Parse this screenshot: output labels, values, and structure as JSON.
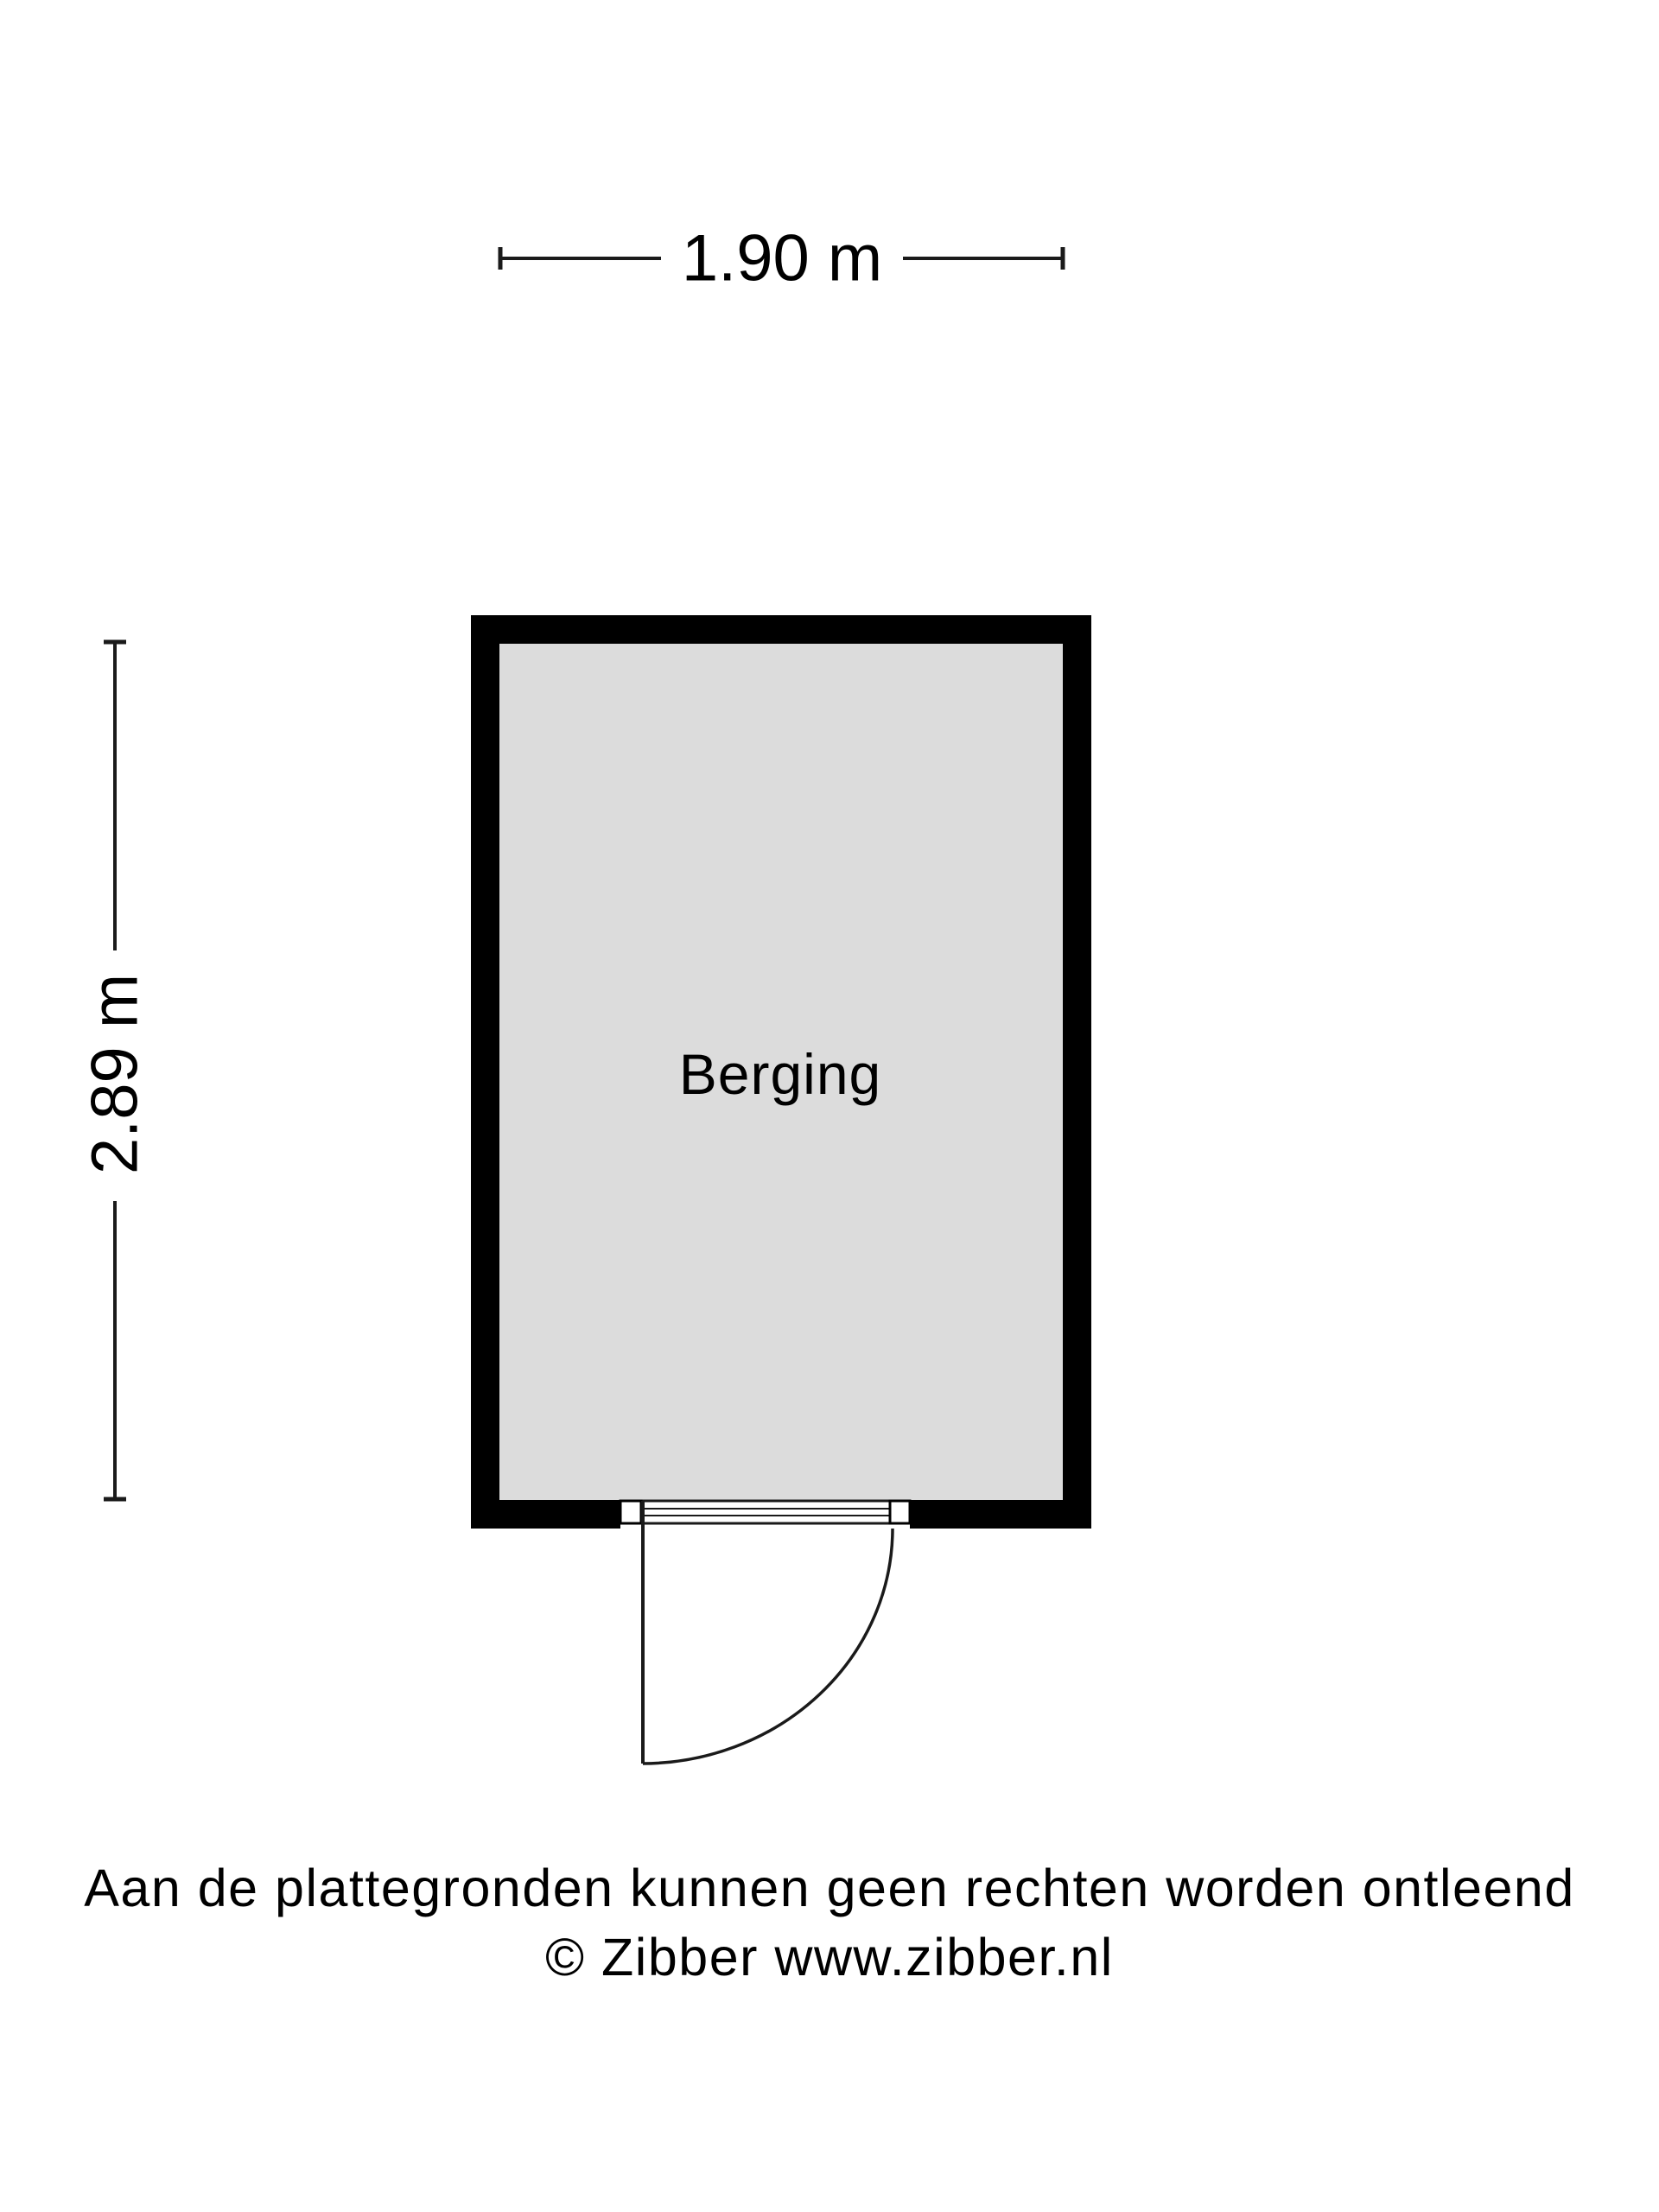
{
  "plan": {
    "room_label": "Berging",
    "dim_width": "1.90 m",
    "dim_height": "2.89 m",
    "disclaimer": "Aan de plattegronden kunnen geen rechten worden ontleend",
    "copyright": "© Zibber www.zibber.nl",
    "colors": {
      "wall": "#000000",
      "room_fill": "#dcdcdc",
      "line": "#1a1a1a",
      "background": "#ffffff"
    }
  }
}
